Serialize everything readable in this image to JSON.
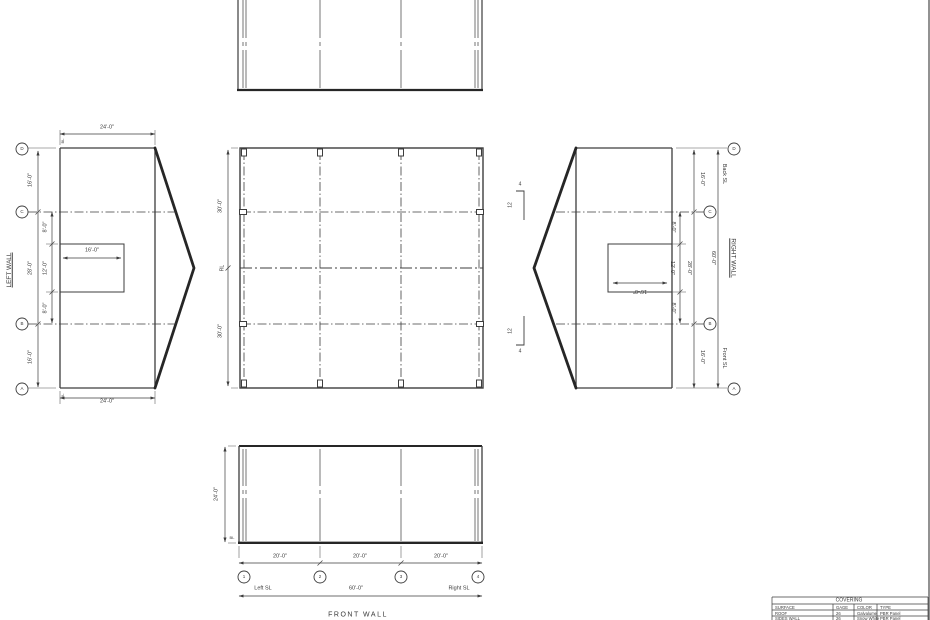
{
  "colors": {
    "line": "#3d3d3d",
    "thick_line": "#262626",
    "text": "#3a3a3a",
    "background": "#ffffff"
  },
  "roof_plan": {
    "dim_upper": "30'-0\"",
    "ridge_label": "RL",
    "dim_lower": "30'-0\""
  },
  "left_wall": {
    "title": "LEFT WALL",
    "dim_width_top": "24'-0\"",
    "dim_width_bottom": "24'-0\"",
    "baseline_top": "BL",
    "baseline_bottom": "BL",
    "bubbles": [
      "D",
      "C",
      "B",
      "A"
    ],
    "dim_d_c": "16'-0\"",
    "dim_c_b": "28'-0\"",
    "dim_b_a": "16'-0\"",
    "dim_c_opening": "8'-0\"",
    "dim_opening_height": "12'-0\"",
    "dim_opening_b": "8'-0\"",
    "dim_opening_width": "16'-0\""
  },
  "right_wall": {
    "title": "RIGHT WALL",
    "bubbles": [
      "D",
      "C",
      "B",
      "A"
    ],
    "back_sl_label": "Back SL",
    "front_sl_label": "Front SL",
    "dim_d_c": "16'-0\"",
    "dim_c_b": "28'-0\"",
    "dim_b_a": "16'-0\"",
    "dim_total": "60'-0\"",
    "dim_c_opening": "8'-0\"",
    "dim_opening_height": "12'-0\"",
    "dim_opening_b": "8'-0\"",
    "dim_opening_width": "16'-0\"",
    "pitch_run": "12",
    "pitch_rise": "4"
  },
  "front_wall": {
    "title": "FRONT WALL",
    "dim_height": "24'-0\"",
    "baseline_label": "BL",
    "bay_dims": [
      "20'-0\"",
      "20'-0\"",
      "20'-0\""
    ],
    "bubbles": [
      "1",
      "2",
      "3",
      "4"
    ],
    "left_sl_label": "Left SL",
    "dim_total": "60'-0\"",
    "right_sl_label": "Right SL"
  },
  "covering_table": {
    "title": "COVERING",
    "headers": [
      "SURFACE",
      "GAGE",
      "COLOR",
      "TYPE"
    ],
    "rows": [
      [
        "ROOF",
        "26",
        "Galvalume",
        "PBR Panel"
      ],
      [
        "SIDES WALL",
        "26",
        "Snow White",
        "PBR Panel"
      ]
    ]
  }
}
